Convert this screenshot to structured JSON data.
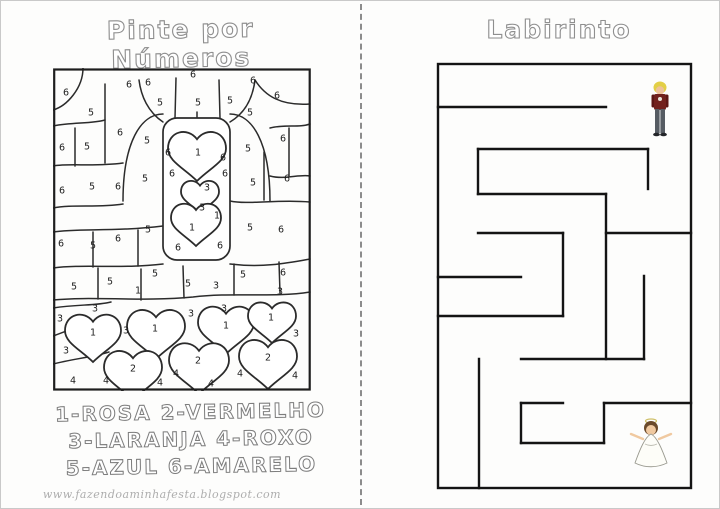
{
  "page": {
    "background": "#fdfdfc",
    "border_color": "#c9c9c9",
    "divider_color": "#8c8c8c",
    "ink_color": "#2b2b2b",
    "maze_wall_color": "#141414"
  },
  "left_page": {
    "title": "Pinte por Números",
    "legend": [
      "1-rosa 2-vermelho",
      "3-laranja 4-roxo",
      "5-azul 6-amarelo"
    ],
    "footer_url": "www.fazendoaminhafesta.blogspot.com",
    "puzzle": {
      "box": [
        0,
        0,
        257,
        322
      ],
      "column": [
        110,
        50,
        67,
        142
      ],
      "hearts": [
        {
          "cx": 144,
          "cy": 84,
          "s": 58
        },
        {
          "cx": 147,
          "cy": 126,
          "s": 38
        },
        {
          "cx": 143,
          "cy": 153,
          "s": 50
        },
        {
          "cx": 40,
          "cy": 266,
          "s": 56
        },
        {
          "cx": 103,
          "cy": 262,
          "s": 58
        },
        {
          "cx": 173,
          "cy": 258,
          "s": 56
        },
        {
          "cx": 219,
          "cy": 251,
          "s": 48
        },
        {
          "cx": 80,
          "cy": 303,
          "s": 58
        },
        {
          "cx": 146,
          "cy": 296,
          "s": 60
        },
        {
          "cx": 215,
          "cy": 292,
          "s": 58
        }
      ],
      "numbers": [
        {
          "x": 13,
          "y": 24,
          "v": "6"
        },
        {
          "x": 38,
          "y": 44,
          "v": "5"
        },
        {
          "x": 76,
          "y": 16,
          "v": "6"
        },
        {
          "x": 95,
          "y": 14,
          "v": "6"
        },
        {
          "x": 107,
          "y": 34,
          "v": "5"
        },
        {
          "x": 140,
          "y": 6,
          "v": "6"
        },
        {
          "x": 145,
          "y": 34,
          "v": "5"
        },
        {
          "x": 177,
          "y": 32,
          "v": "5"
        },
        {
          "x": 200,
          "y": 12,
          "v": "6"
        },
        {
          "x": 224,
          "y": 27,
          "v": "6"
        },
        {
          "x": 197,
          "y": 44,
          "v": "5"
        },
        {
          "x": 67,
          "y": 64,
          "v": "6"
        },
        {
          "x": 94,
          "y": 72,
          "v": "5"
        },
        {
          "x": 9,
          "y": 79,
          "v": "6"
        },
        {
          "x": 34,
          "y": 78,
          "v": "5"
        },
        {
          "x": 115,
          "y": 84,
          "v": "6"
        },
        {
          "x": 145,
          "y": 84,
          "v": "1"
        },
        {
          "x": 170,
          "y": 89,
          "v": "6"
        },
        {
          "x": 195,
          "y": 80,
          "v": "5"
        },
        {
          "x": 230,
          "y": 70,
          "v": "6"
        },
        {
          "x": 9,
          "y": 122,
          "v": "6"
        },
        {
          "x": 39,
          "y": 118,
          "v": "5"
        },
        {
          "x": 65,
          "y": 118,
          "v": "6"
        },
        {
          "x": 92,
          "y": 110,
          "v": "5"
        },
        {
          "x": 119,
          "y": 105,
          "v": "6"
        },
        {
          "x": 172,
          "y": 105,
          "v": "6"
        },
        {
          "x": 200,
          "y": 114,
          "v": "5"
        },
        {
          "x": 234,
          "y": 110,
          "v": "6"
        },
        {
          "x": 154,
          "y": 119,
          "v": "3"
        },
        {
          "x": 149,
          "y": 139,
          "v": "3"
        },
        {
          "x": 164,
          "y": 147,
          "v": "1"
        },
        {
          "x": 139,
          "y": 159,
          "v": "1"
        },
        {
          "x": 125,
          "y": 179,
          "v": "6"
        },
        {
          "x": 167,
          "y": 177,
          "v": "6"
        },
        {
          "x": 197,
          "y": 159,
          "v": "5"
        },
        {
          "x": 8,
          "y": 175,
          "v": "6"
        },
        {
          "x": 40,
          "y": 177,
          "v": "5"
        },
        {
          "x": 65,
          "y": 170,
          "v": "6"
        },
        {
          "x": 95,
          "y": 161,
          "v": "5"
        },
        {
          "x": 228,
          "y": 161,
          "v": "6"
        },
        {
          "x": 21,
          "y": 218,
          "v": "5"
        },
        {
          "x": 57,
          "y": 213,
          "v": "5"
        },
        {
          "x": 102,
          "y": 205,
          "v": "5"
        },
        {
          "x": 135,
          "y": 215,
          "v": "5"
        },
        {
          "x": 163,
          "y": 217,
          "v": "3"
        },
        {
          "x": 190,
          "y": 206,
          "v": "5"
        },
        {
          "x": 230,
          "y": 204,
          "v": "6"
        },
        {
          "x": 85,
          "y": 222,
          "v": "1"
        },
        {
          "x": 227,
          "y": 223,
          "v": "3"
        },
        {
          "x": 7,
          "y": 250,
          "v": "3"
        },
        {
          "x": 42,
          "y": 240,
          "v": "3"
        },
        {
          "x": 40,
          "y": 264,
          "v": "1"
        },
        {
          "x": 73,
          "y": 262,
          "v": "3"
        },
        {
          "x": 102,
          "y": 260,
          "v": "1"
        },
        {
          "x": 138,
          "y": 245,
          "v": "3"
        },
        {
          "x": 171,
          "y": 240,
          "v": "3"
        },
        {
          "x": 173,
          "y": 257,
          "v": "1"
        },
        {
          "x": 218,
          "y": 249,
          "v": "1"
        },
        {
          "x": 243,
          "y": 265,
          "v": "3"
        },
        {
          "x": 13,
          "y": 282,
          "v": "3"
        },
        {
          "x": 80,
          "y": 300,
          "v": "2"
        },
        {
          "x": 145,
          "y": 292,
          "v": "2"
        },
        {
          "x": 215,
          "y": 289,
          "v": "2"
        },
        {
          "x": 20,
          "y": 312,
          "v": "4"
        },
        {
          "x": 53,
          "y": 312,
          "v": "4"
        },
        {
          "x": 107,
          "y": 314,
          "v": "4"
        },
        {
          "x": 123,
          "y": 305,
          "v": "4"
        },
        {
          "x": 158,
          "y": 315,
          "v": "4"
        },
        {
          "x": 187,
          "y": 305,
          "v": "4"
        },
        {
          "x": 242,
          "y": 307,
          "v": "4"
        }
      ]
    }
  },
  "right_page": {
    "title": "Labirinto",
    "maze": {
      "outer": [
        437,
        63,
        690,
        487
      ],
      "walls": [
        [
          437,
          106,
          605,
          106
        ],
        [
          477,
          148,
          647,
          148
        ],
        [
          647,
          148,
          647,
          188
        ],
        [
          477,
          148,
          477,
          193
        ],
        [
          477,
          193,
          605,
          193
        ],
        [
          605,
          193,
          605,
          358
        ],
        [
          605,
          232,
          690,
          232
        ],
        [
          477,
          232,
          562,
          232
        ],
        [
          562,
          232,
          562,
          315
        ],
        [
          437,
          315,
          562,
          315
        ],
        [
          437,
          276,
          520,
          276
        ],
        [
          643,
          275,
          643,
          358
        ],
        [
          520,
          358,
          643,
          358
        ],
        [
          478,
          358,
          478,
          487
        ],
        [
          520,
          402,
          562,
          402
        ],
        [
          520,
          402,
          520,
          442
        ],
        [
          520,
          442,
          603,
          442
        ],
        [
          603,
          402,
          603,
          442
        ],
        [
          603,
          402,
          690,
          402
        ]
      ]
    },
    "characters": {
      "prince": {
        "hair": "#e3cf46",
        "skin": "#eec29a",
        "jacket": "#72211d",
        "sleeves": "#5d1715",
        "pants": "#565c63",
        "shoes": "#24262a"
      },
      "bride": {
        "hair": "#6b4a2b",
        "skin": "#f0c9a0",
        "dress": "#fdfdf8",
        "halo": "#cfc06a"
      }
    }
  }
}
